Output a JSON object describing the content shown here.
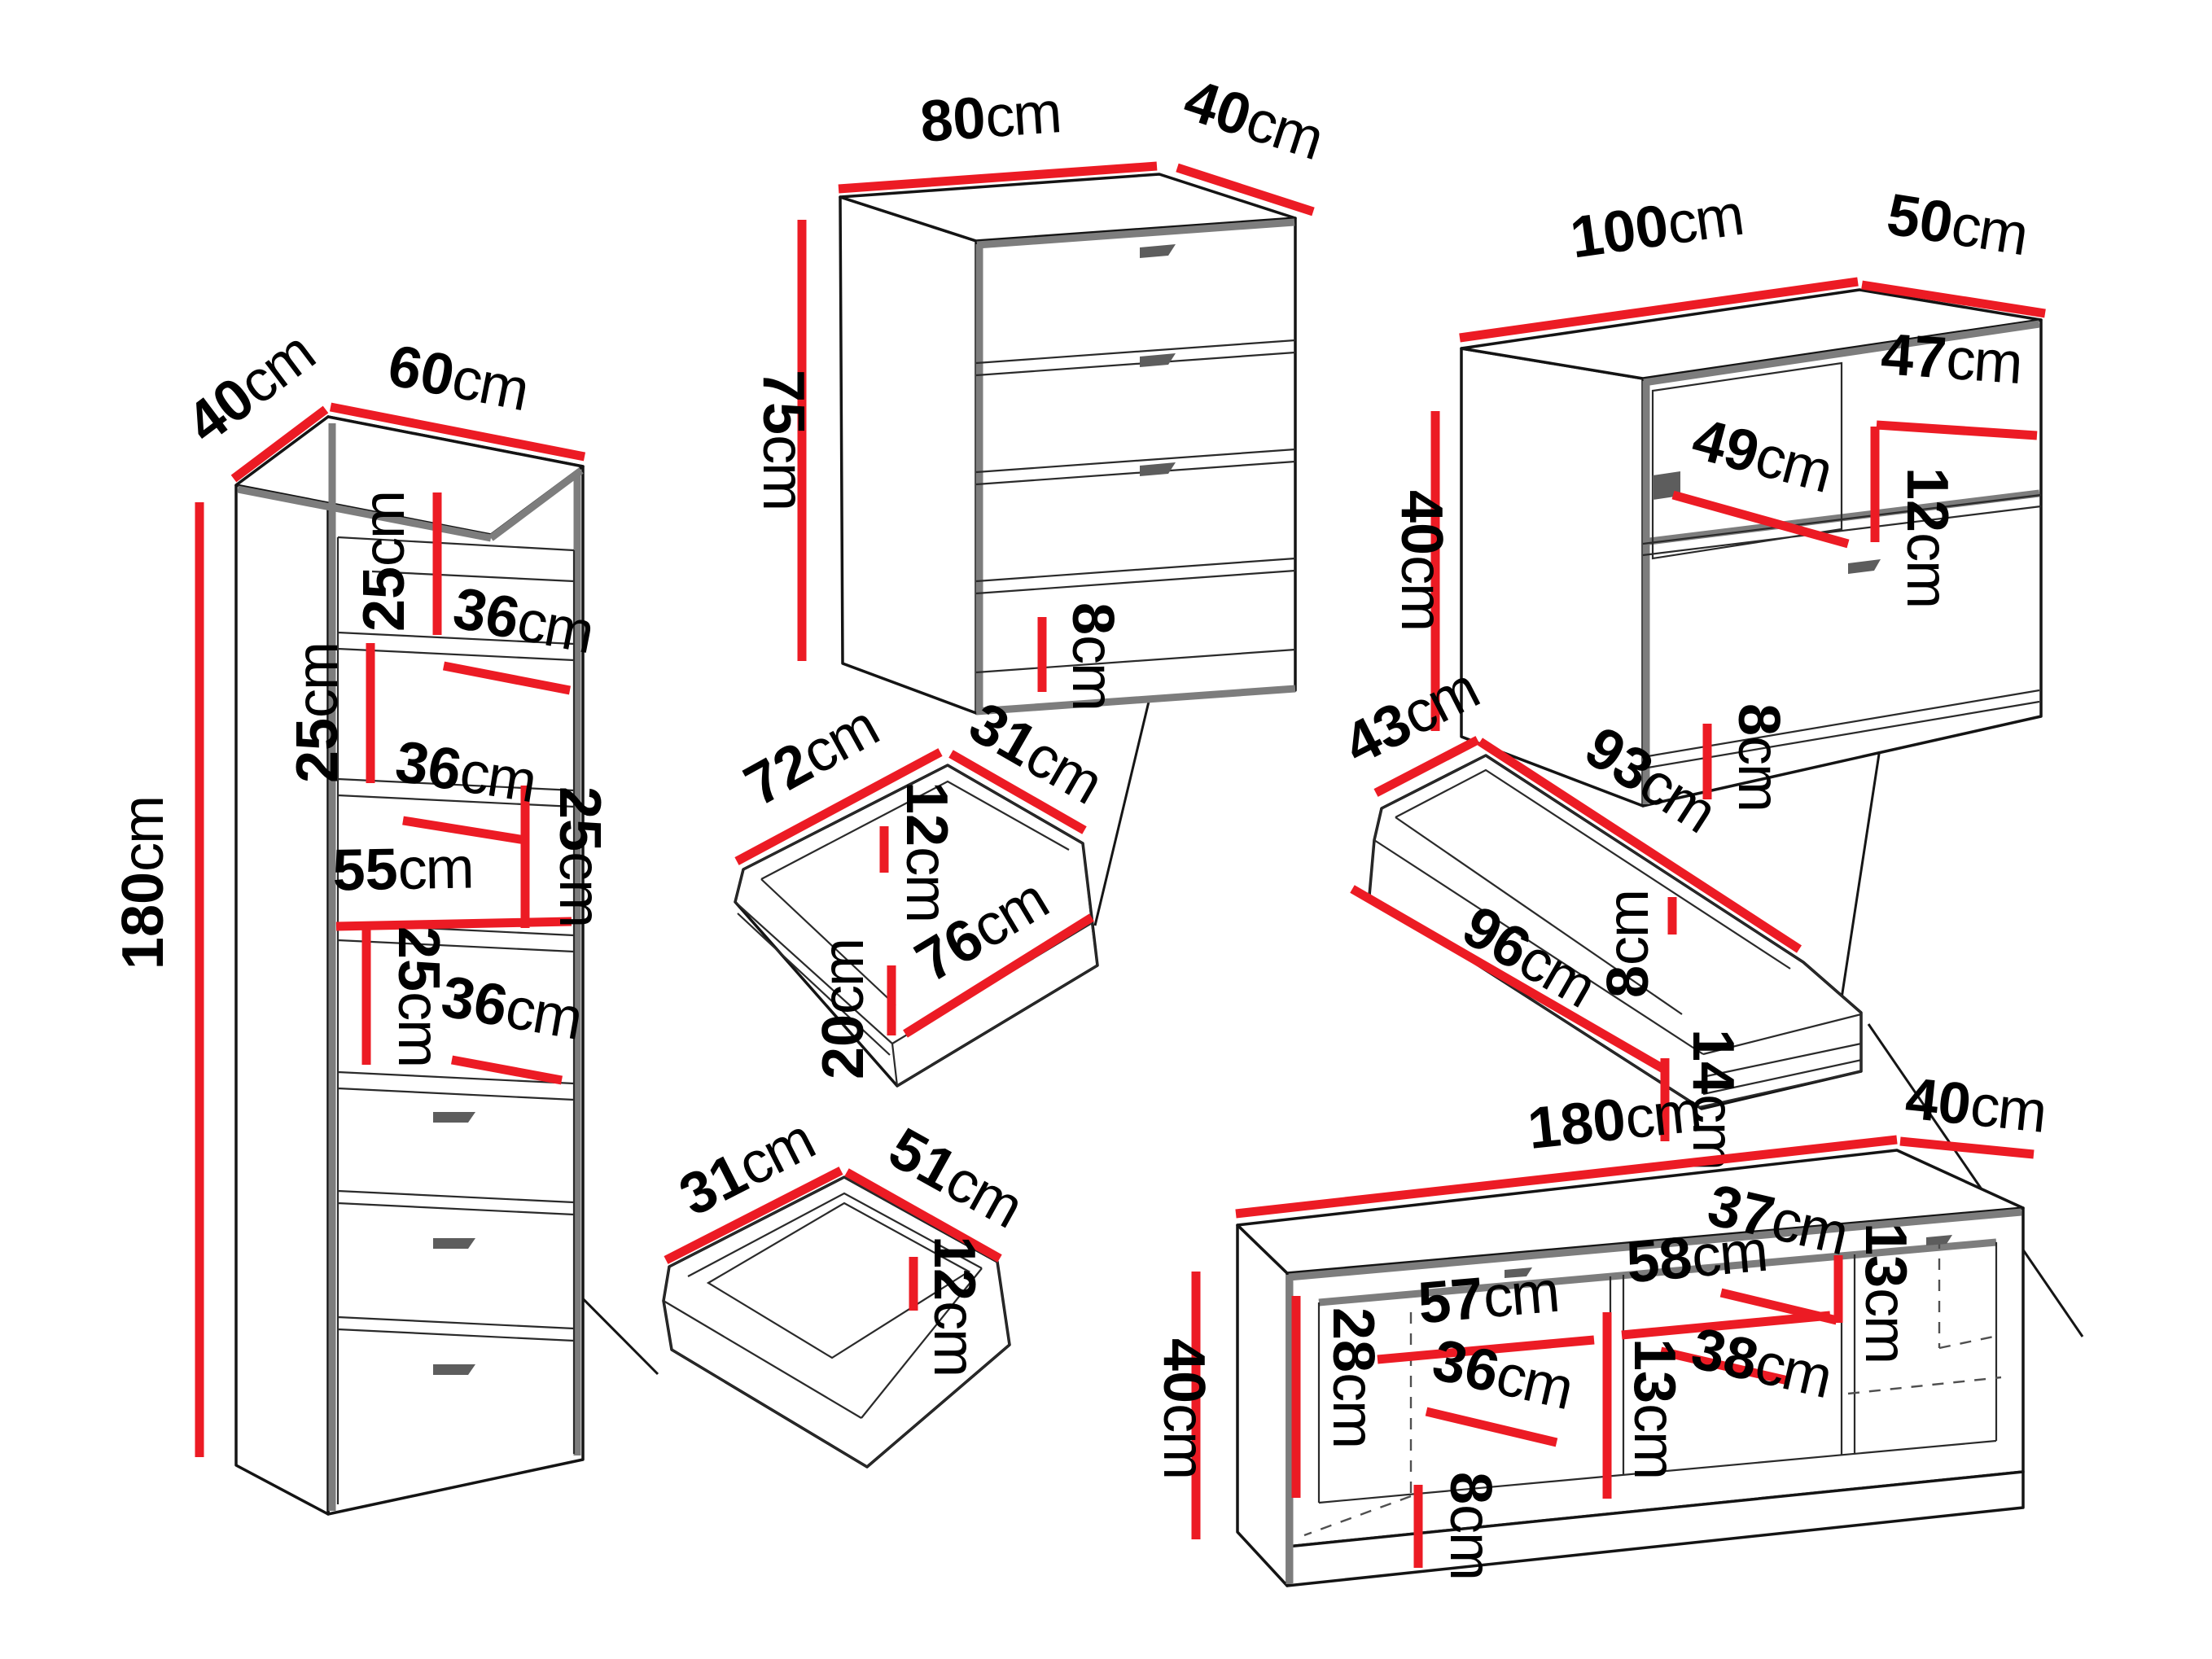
{
  "unit": "cm",
  "colors": {
    "dimension_line": "#ec1b24",
    "furniture_outline": "#141414",
    "furniture_shade": "#7d7d7d",
    "label_text": "#000000",
    "background": "#ffffff"
  },
  "dims": {
    "bookcase": {
      "depth": "40",
      "width": "60",
      "height": "180",
      "shelf_h1": "25",
      "shelf_w1": "36",
      "shelf_h2": "25",
      "shelf_w2": "36",
      "shelf_h3": "25",
      "span": "55",
      "shelf_h4": "25",
      "shelf_w3": "36"
    },
    "chest": {
      "width": "80",
      "depth": "40",
      "height": "75",
      "plinth": "8"
    },
    "tv_cabinet": {
      "width": "100",
      "depth": "50",
      "height": "40",
      "door_w": "49",
      "niche_w": "47",
      "niche_h": "12",
      "plinth": "8"
    },
    "chest_drawer": {
      "outer_w": "72",
      "depth": "31",
      "inner_h": "12",
      "front_w": "76",
      "front_h": "20"
    },
    "tv_drawer": {
      "depth": "43",
      "inner_w": "93",
      "inner_h": "8",
      "front_w": "96",
      "front_h": "14"
    },
    "bookcase_drawer": {
      "depth": "31",
      "width": "51",
      "inner_h": "12"
    },
    "tv_stand": {
      "width": "180",
      "depth": "40",
      "height": "40",
      "niche_h": "28",
      "bay1_w": "57",
      "bay1_d": "36",
      "plinth": "8",
      "divider1": "13",
      "shelf1_w": "37",
      "bay2_w": "58",
      "shelf2_w": "38",
      "divider2": "13"
    }
  }
}
